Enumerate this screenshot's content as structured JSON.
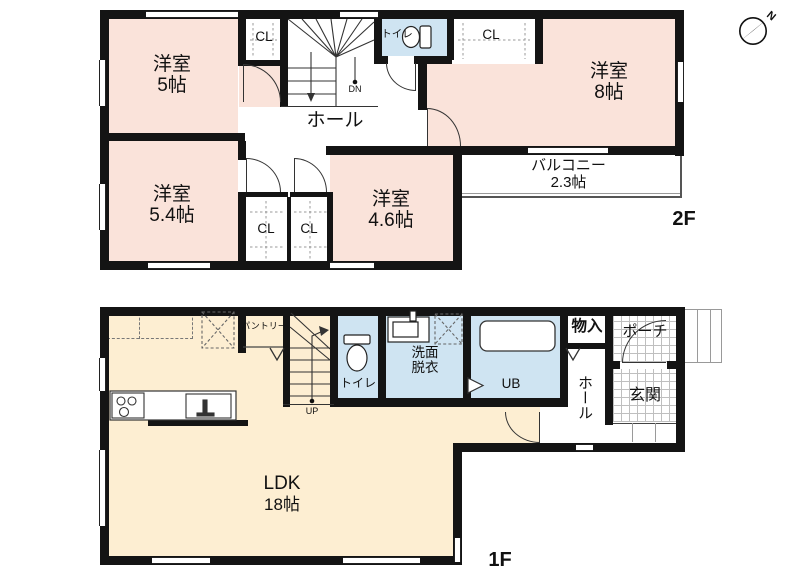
{
  "compass": {
    "north_label": "N"
  },
  "colors": {
    "bedroom_fill": "#fae3da",
    "ldk_fill": "#fdeed2",
    "wet_fill": "#cfe4f2",
    "wall": "#141414"
  },
  "floor2": {
    "floor_label": "2F",
    "bedroom_5": {
      "name": "洋室",
      "size": "5帖"
    },
    "bedroom_8": {
      "name": "洋室",
      "size": "8帖"
    },
    "bedroom_5_4": {
      "name": "洋室",
      "size": "5.4帖"
    },
    "bedroom_4_6": {
      "name": "洋室",
      "size": "4.6帖"
    },
    "hall": {
      "name": "ホール"
    },
    "toilet": {
      "name": "トイレ"
    },
    "balcony": {
      "name": "バルコニー",
      "size": "2.3帖"
    },
    "closet_top_left": {
      "name": "CL"
    },
    "closet_top_right": {
      "name": "CL"
    },
    "closet_bottom_left": {
      "name": "CL"
    },
    "closet_bottom_right": {
      "name": "CL"
    },
    "stairs": {
      "direction_label": "DN"
    }
  },
  "floor1": {
    "floor_label": "1F",
    "ldk": {
      "name": "LDK",
      "size": "18帖"
    },
    "toilet": {
      "name": "トイレ"
    },
    "washroom": {
      "line1": "洗面",
      "line2": "脱衣"
    },
    "bath": {
      "name": "UB"
    },
    "storage": {
      "name": "物入"
    },
    "hall": {
      "name": "ホール"
    },
    "entrance": {
      "name": "玄関"
    },
    "porch": {
      "name": "ポーチ"
    },
    "pantry": {
      "name": "パントリー"
    },
    "stairs": {
      "direction_label": "UP"
    }
  }
}
